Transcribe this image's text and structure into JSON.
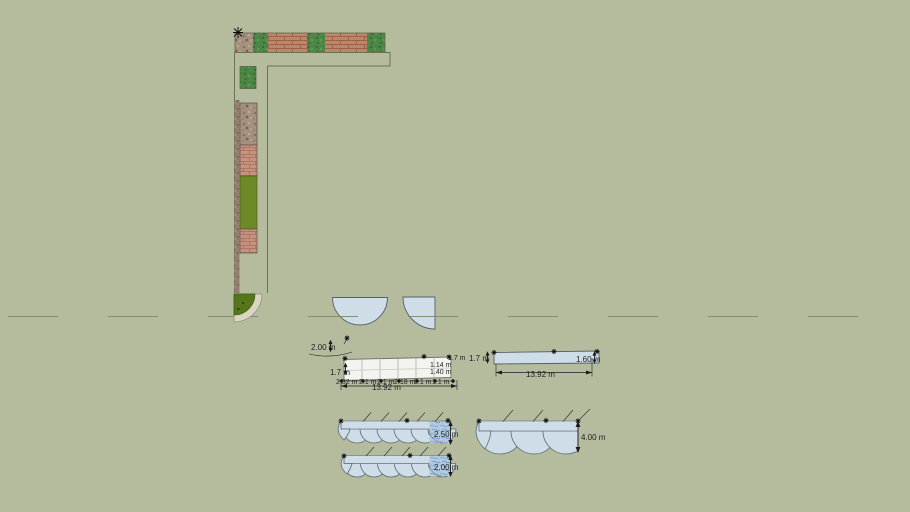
{
  "canvas": {
    "background": "#b5bc9e"
  },
  "colors": {
    "pool_fill": "#cfdde9",
    "pool_outline": "#566069",
    "deck_fill": "#f3f3ef",
    "brick": "#c08568",
    "pink_brick": "#c7917f",
    "grass": "#4c8745",
    "stone": "#a5917f",
    "olive": "#6d8a26",
    "lawn_quarter": "#55761b",
    "path_band": "#d8d5c3",
    "water": "#b2cadf",
    "dashed_guide": "#878d74",
    "dimension_text": "#1f1f1f"
  },
  "icons": {
    "guide_point": "✛",
    "origin_cross": "✕",
    "arrow_up": "▲",
    "arrow_down": "▼",
    "arrow_left": "◀",
    "arrow_right": "▶"
  },
  "dimensions": {
    "pool_width": "2.00 m",
    "deck_left_height": "1.7 m",
    "deck_right_height": "1.7 m",
    "deck_right_upper": "1.14 m",
    "deck_right_lower": "1.40 m",
    "deck_segments": [
      "2.32 m",
      "2.1 m",
      "2.1 m",
      "2.18 m",
      "2.1 m",
      "1.1 m"
    ],
    "deck_total": "13.92 m",
    "bar_left_height": "1.7 m",
    "bar_right_height": "1.60 m",
    "bar_total": "13.92 m",
    "awning_top_height": "2.50 m",
    "awning_large_height": "4.00 m",
    "awning_bottom_height": "2.00 m"
  }
}
